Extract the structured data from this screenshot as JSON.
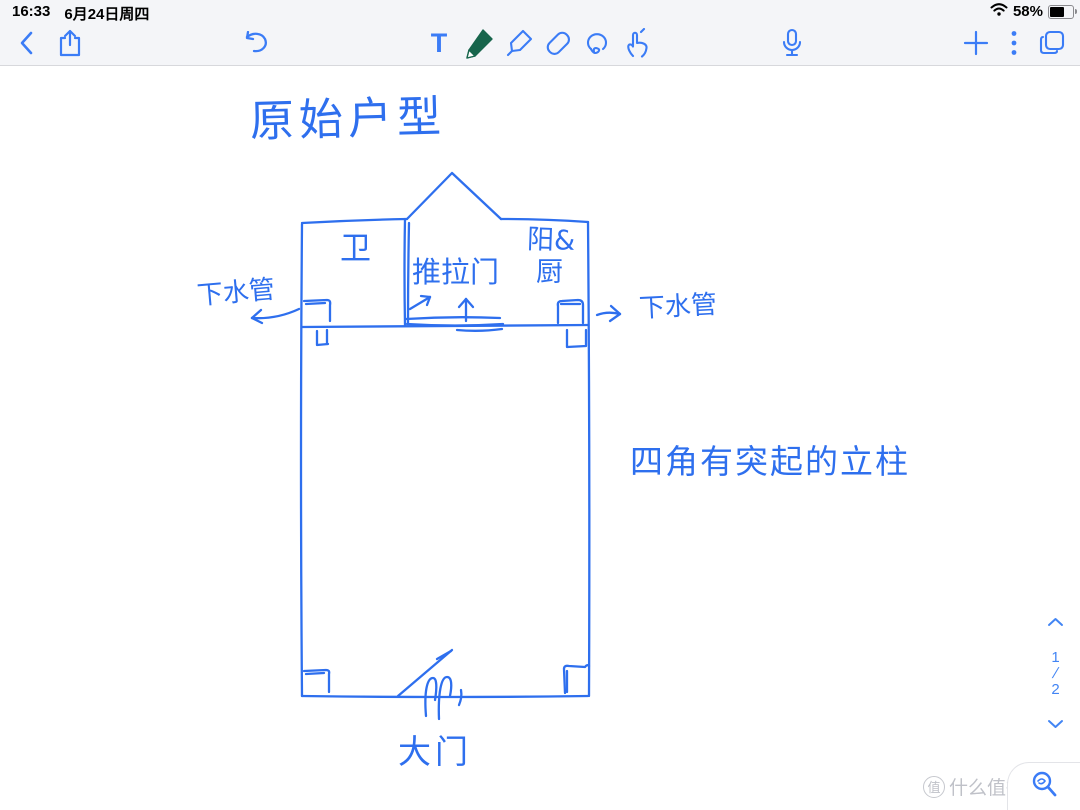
{
  "status_bar": {
    "time": "16:33",
    "date": "6月24日周四",
    "battery_percent": "58%"
  },
  "toolbar": {
    "text_tool_glyph": "T",
    "tools": [
      "back",
      "share",
      "undo",
      "text",
      "pen",
      "highlighter",
      "eraser",
      "lasso",
      "hand",
      "microphone",
      "add",
      "more",
      "pages"
    ],
    "selected_tool": "pen"
  },
  "sketch": {
    "title": "原始户型",
    "room_bathroom": "卫",
    "sliding_door_label": "推拉门",
    "balcony_kitchen_line1": "阳&",
    "balcony_kitchen_line2": "厨",
    "drain_pipe_left": "下水管",
    "drain_pipe_right": "下水管",
    "columns_note": "四角有突起的立柱",
    "main_door_label": "大门"
  },
  "page_nav": {
    "current": "1",
    "separator": "/",
    "total": "2"
  },
  "watermark": {
    "badge": "值",
    "text": "什么值得买"
  },
  "colors": {
    "ink_blue": "#2e6fee",
    "toolbar_blue": "#3b7cf6",
    "pen_green": "#17654c",
    "chrome_bg": "#f4f5f8",
    "watermark_gray": "#bfc1c8"
  }
}
